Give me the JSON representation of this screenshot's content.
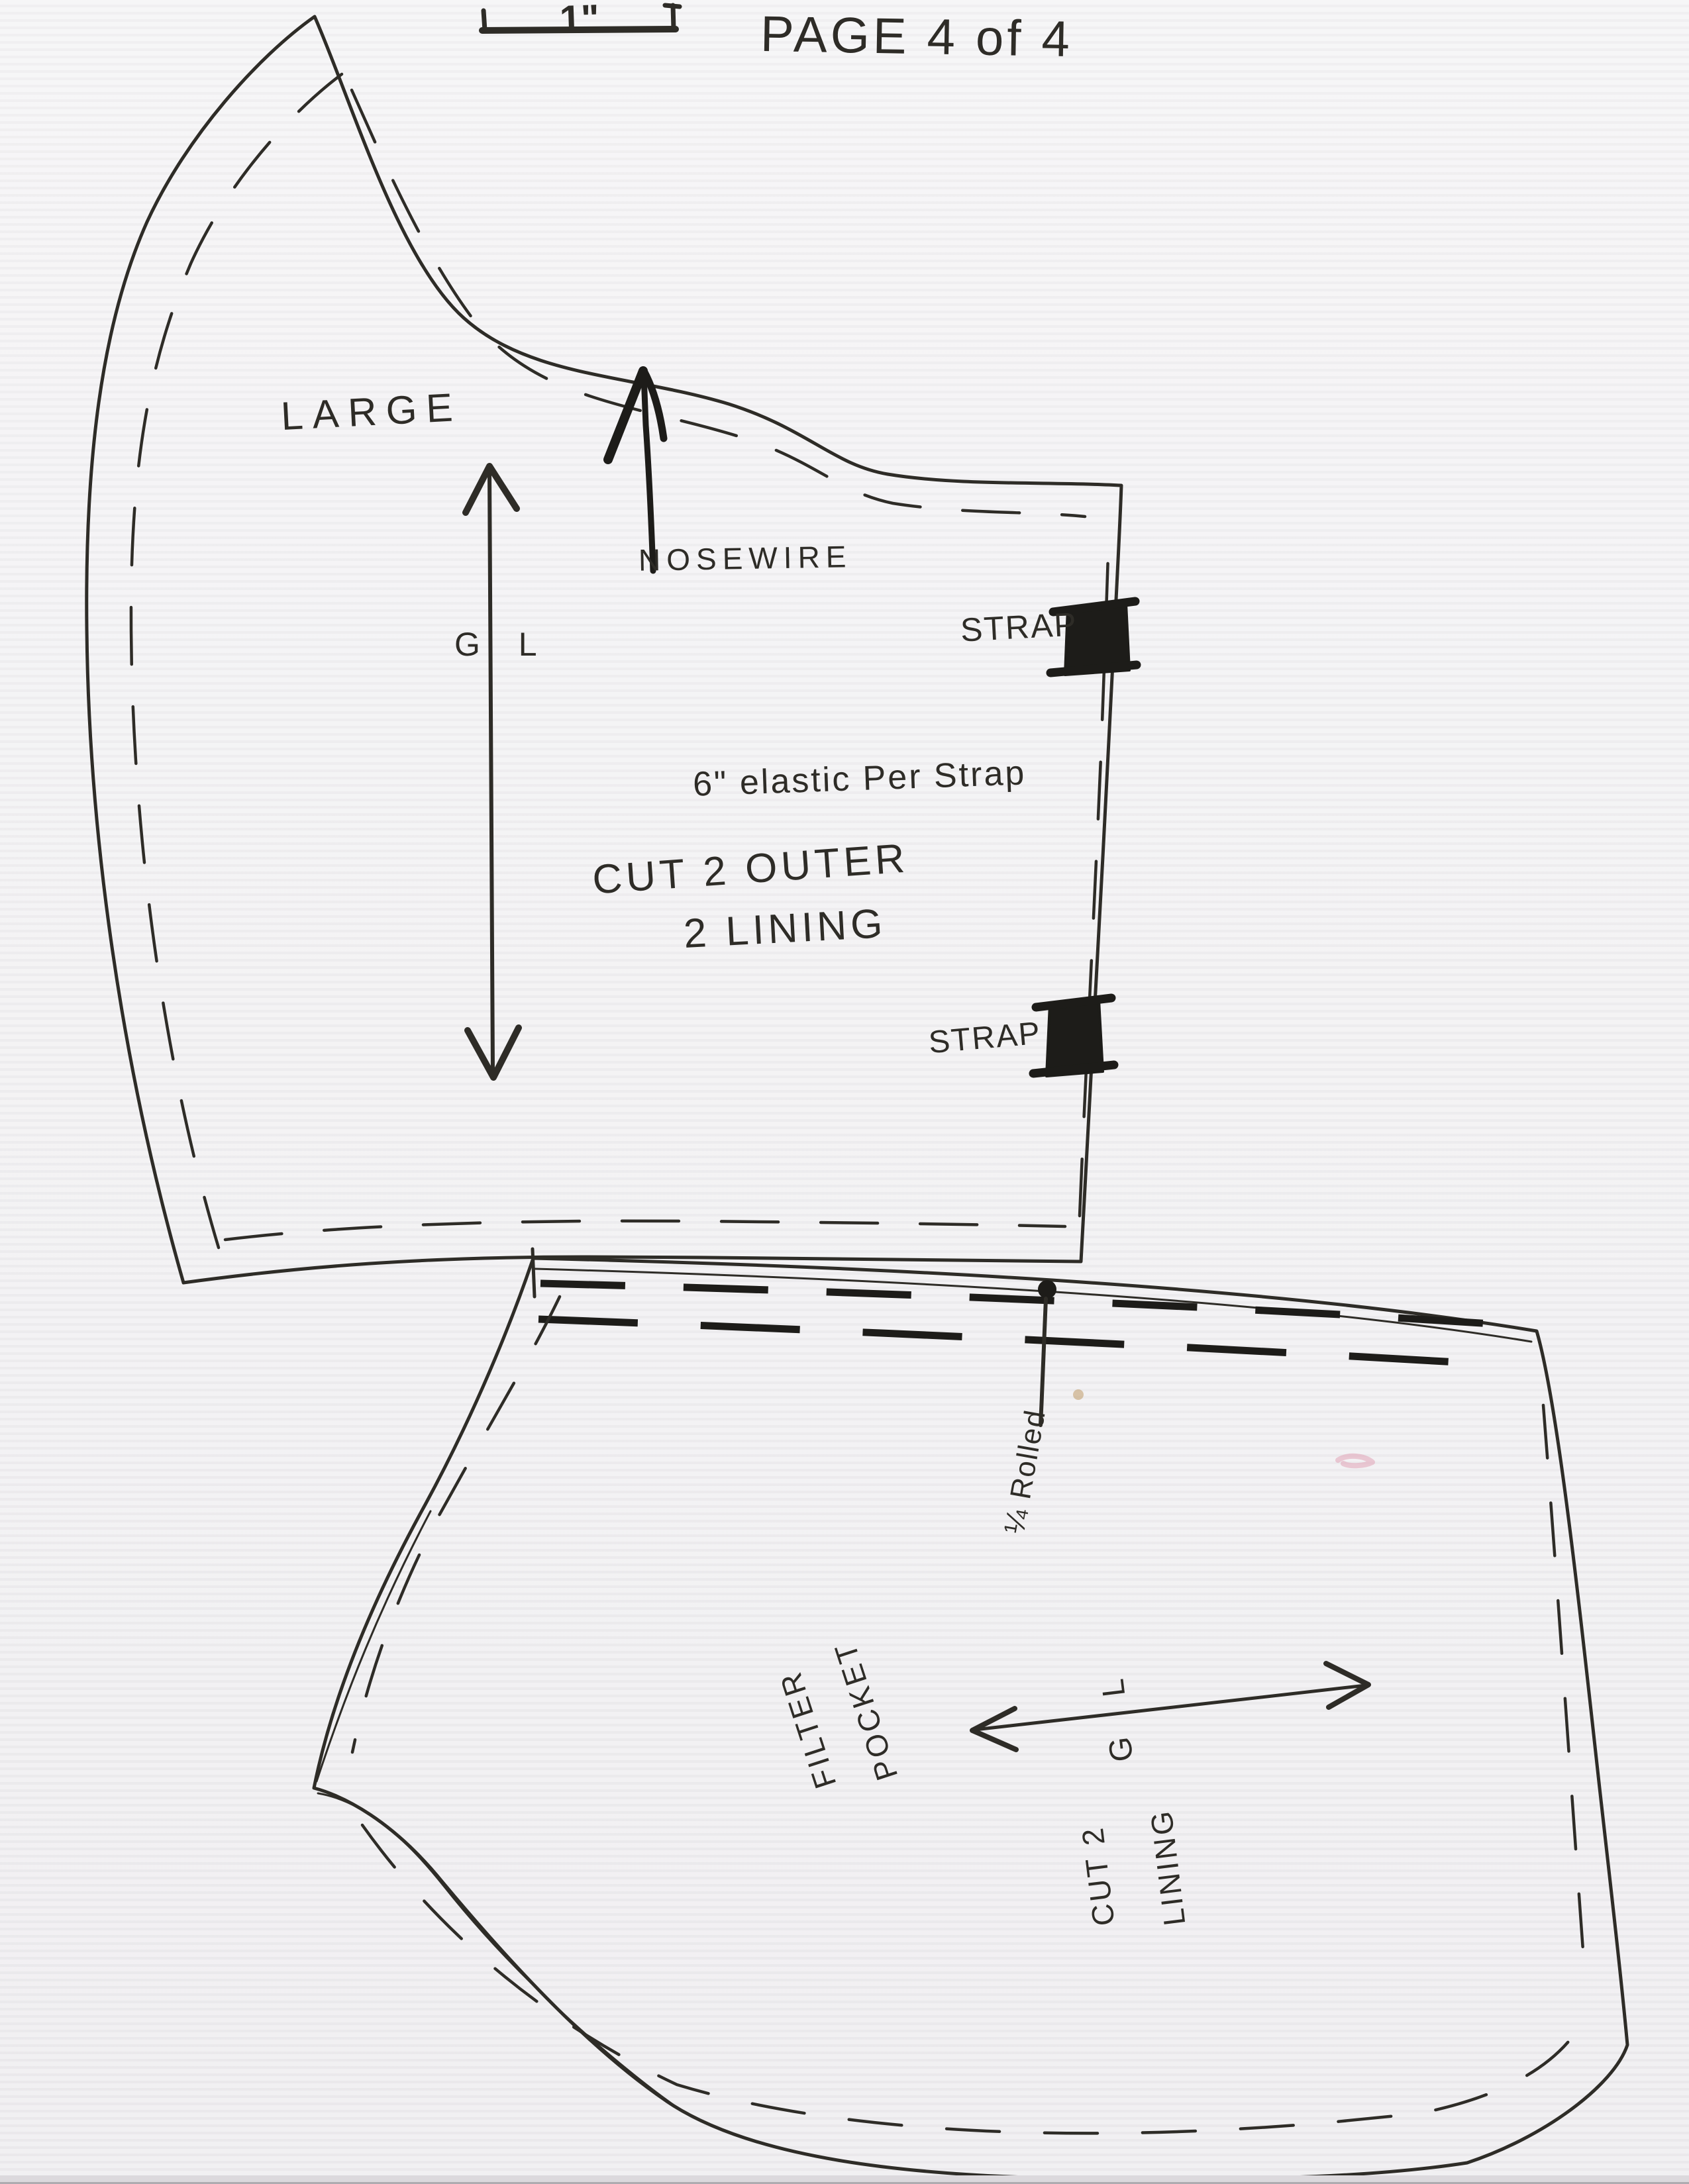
{
  "page": {
    "label": "PAGE 4 of 4",
    "scale_label": "1\""
  },
  "colors": {
    "ink": "#2e2c27",
    "heavy_ink": "#1d1c19",
    "paper": "#f1f0f2",
    "smudge_pink": "#e09cb2"
  },
  "top_piece": {
    "size_label": "LARGE",
    "nosewire_label": "NOSEWIRE",
    "grainline_label": "G L",
    "elastic_note": "6\" elastic Per Strap",
    "cut_note_line1": "CUT 2 OUTER",
    "cut_note_line2": "2 LINING",
    "strap_label_top": "STRAP",
    "strap_label_bottom": "STRAP"
  },
  "bottom_piece": {
    "hem_note": "¼ Rolled",
    "pocket_label_line1": "FILTER",
    "pocket_label_line2": "POCKET",
    "grainline_label": "G L",
    "cut_note_line1": "CUT 2",
    "cut_note_line2": "LINING"
  }
}
